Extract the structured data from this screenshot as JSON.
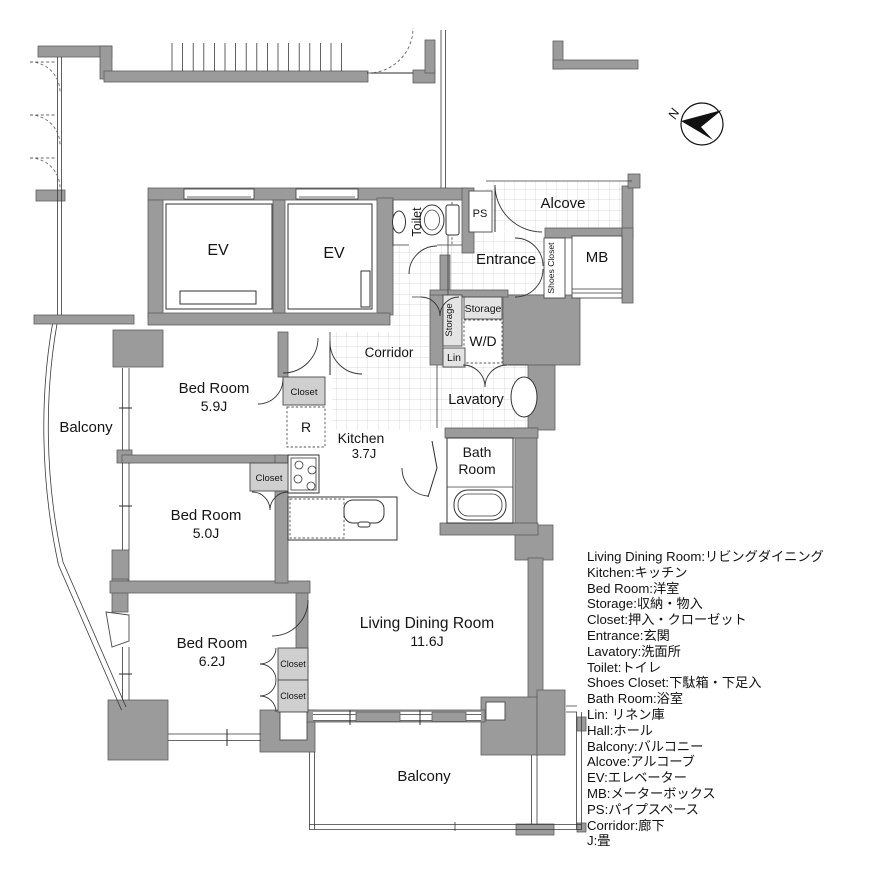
{
  "labels": {
    "ev1": "EV",
    "ev2": "EV",
    "toilet": "Toilet",
    "ps": "PS",
    "alcove": "Alcove",
    "entrance": "Entrance",
    "shoes_closet": "Shoes Closet",
    "mb": "MB",
    "storage_side": "Storage",
    "storage_top": "Storage",
    "wd": "W/D",
    "lin": "Lin",
    "lavatory": "Lavatory",
    "corridor": "Corridor",
    "bath_1": "Bath",
    "bath_2": "Room",
    "kitchen": "Kitchen",
    "kitchen_size": "3.7J",
    "fridge": "R",
    "bedroom1": "Bed Room",
    "bedroom1_size": "5.9J",
    "bedroom2": "Bed Room",
    "bedroom2_size": "5.0J",
    "bedroom3": "Bed Room",
    "bedroom3_size": "6.2J",
    "closet1": "Closet",
    "closet2": "Closet",
    "closet3": "Closet",
    "closet4": "Closet",
    "ldk": "Living Dining Room",
    "ldk_size": "11.6J",
    "balcony_left": "Balcony",
    "balcony_bottom": "Balcony",
    "north": "N"
  },
  "legend": {
    "lines": [
      "Living Dining Room:リビングダイニング",
      "Kitchen:キッチン",
      "Bed Room:洋室",
      "Storage:収納・物入",
      "Closet:押入・クローゼット",
      "Entrance:玄関",
      "Lavatory:洗面所",
      "Toilet:トイレ",
      "Shoes Closet:下駄箱・下足入",
      "Bath Room:浴室",
      "Lin: リネン庫",
      "Hall:ホール",
      "Balcony:バルコニー",
      "Alcove:アルコーブ",
      "EV:エレベーター",
      "MB:メーターボックス",
      "PS:パイプスペース",
      "Corridor:廊下",
      "J:畳"
    ]
  },
  "colors": {
    "wall": "#9b9b9b",
    "closet_fill": "#cfcfcf",
    "tile_line": "#cdcdcd",
    "line": "#2b2b2b",
    "text": "#111111",
    "background": "#ffffff"
  }
}
